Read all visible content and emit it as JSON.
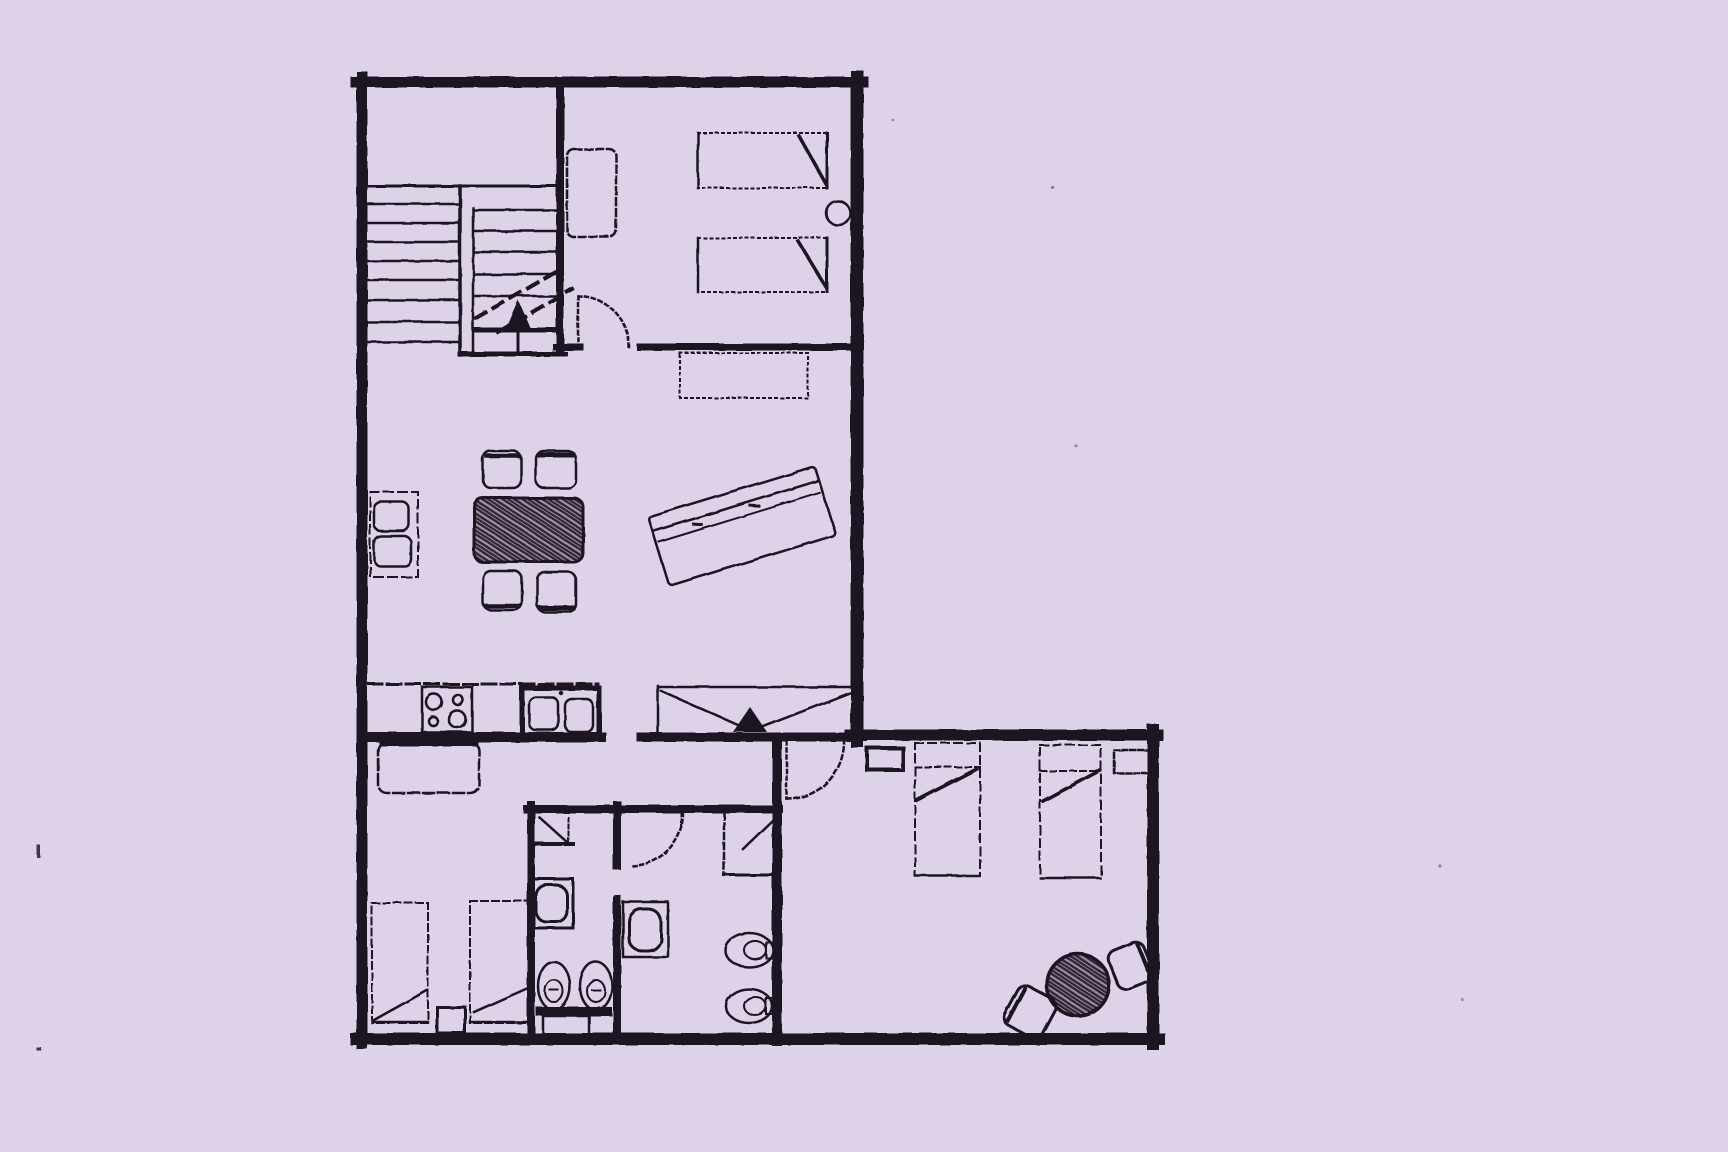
{
  "document_type": "scanned-floor-plan",
  "canvas": {
    "width": 1728,
    "height": 1152
  },
  "colors": {
    "paper": "#ded2e9",
    "ink": "#1c1220"
  },
  "plan": {
    "shape": "L-shaped apartment, upper rectangle with lower-right extension",
    "rooms": [
      {
        "name": "stairwell",
        "features": [
          "staircase-left-flight",
          "staircase-right-flight",
          "stair-divider",
          "direction-dashes",
          "up-arrow"
        ]
      },
      {
        "name": "bedroom-upper-right",
        "features": [
          "wardrobe",
          "twin-bed-1",
          "twin-bed-2",
          "round-wall-item",
          "door-swing"
        ]
      },
      {
        "name": "living-dining",
        "features": [
          "wall-bench-with-two-seats",
          "dining-table-scribbled",
          "chair-top-left",
          "chair-top-right",
          "chair-bottom-left",
          "chair-bottom-right",
          "sofa-rotated",
          "sideboard-dotted"
        ]
      },
      {
        "name": "kitchen",
        "features": [
          "worktop-edge",
          "cooktop-four-burners",
          "double-sink-unit",
          "island-table"
        ]
      },
      {
        "name": "entrance",
        "features": [
          "entry-box",
          "v-threshold-lines",
          "arrow-head",
          "door-swing-lower"
        ]
      },
      {
        "name": "bathroom-left",
        "features": [
          "corner-shower",
          "washbasin",
          "toilet-1",
          "toilet-2",
          "base-strip",
          "floor-mat"
        ]
      },
      {
        "name": "bathroom-right",
        "features": [
          "door-swing",
          "shower-cabin-diagonal",
          "washbasin",
          "toilet-1",
          "toilet-2"
        ]
      },
      {
        "name": "bedroom-lower-left",
        "features": [
          "bed-1",
          "bed-2",
          "nightstand"
        ]
      },
      {
        "name": "bedroom-lower-right",
        "features": [
          "wall-shelf",
          "bed-1",
          "bed-2",
          "nightstand",
          "round-table-scribbled",
          "chair-right",
          "chair-lower"
        ]
      }
    ],
    "scan_artifacts": [
      "left-margin-tick-upper",
      "left-margin-tick-lower",
      "speck-1",
      "speck-2",
      "speck-3",
      "speck-4",
      "speck-5"
    ]
  }
}
